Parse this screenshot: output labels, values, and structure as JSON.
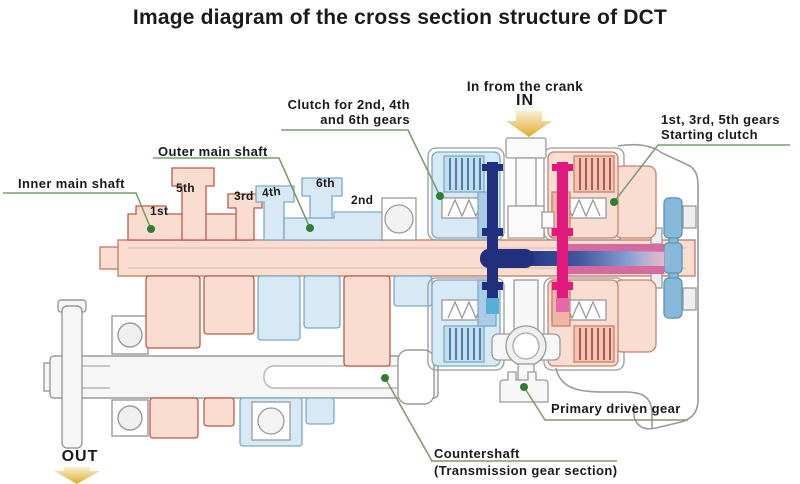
{
  "title": "Image diagram of the cross section structure of DCT",
  "labels": {
    "in_from_crank": "In from the crank",
    "in_word": "IN",
    "out_word": "OUT",
    "clutch_246_line1": "Clutch for 2nd, 4th",
    "clutch_246_line2": "and 6th gears",
    "gears_135_line1": "1st, 3rd, 5th gears",
    "gears_135_line2": "Starting clutch",
    "outer_main_shaft": "Outer main shaft",
    "inner_main_shaft": "Inner main shaft",
    "primary_driven_gear": "Primary driven gear",
    "countershaft_line1": "Countershaft",
    "countershaft_line2": "(Transmission gear section)"
  },
  "gear_labels": {
    "first": "1st",
    "second": "2nd",
    "third": "3rd",
    "fourth": "4th",
    "fifth": "5th",
    "sixth": "6th"
  },
  "colors": {
    "pink-fill": "#f9ddd1",
    "pink-stroke": "#c97f6d",
    "pink-dark": "#bd5a49",
    "blue-fill": "#d7e9f4",
    "blue-stroke": "#7baac5",
    "blue-dark": "#4d7fa6",
    "gray-stroke": "#9a9a9a",
    "gray-fill": "#f6f6f6",
    "navy": "#20307f",
    "magenta": "#e2197d",
    "magenta-mid": "#d36aa0",
    "magenta-light": "#ecb9cf",
    "flywheel-blue": "#86b8da",
    "green-line": "#7e9c72",
    "green-dot": "#2e7d32",
    "arrow-light": "#f8efd2",
    "arrow-dark": "#e2ab2e"
  }
}
